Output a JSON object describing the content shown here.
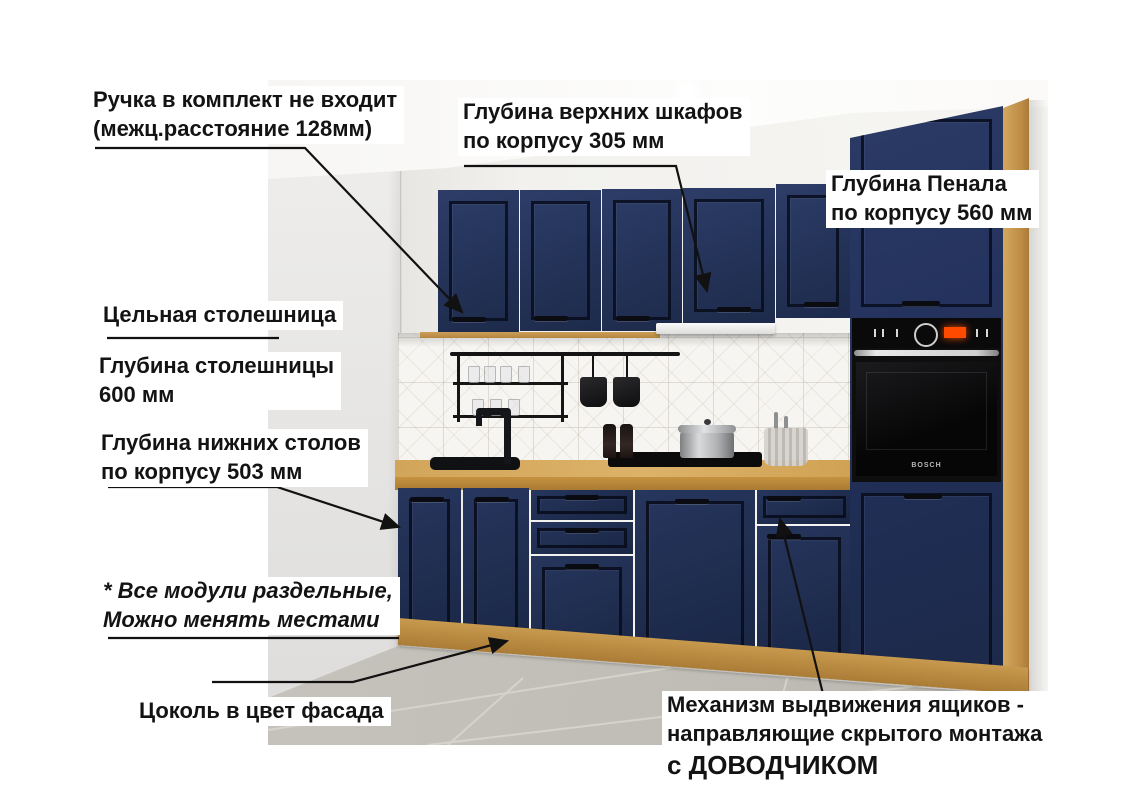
{
  "annotations": {
    "handle_note": {
      "line1": "Ручка в комплект не входит",
      "line2": "(межц.расстояние 128мм)"
    },
    "upper_cabinets_depth": {
      "line1": "Глубина верхних шкафов",
      "line2": "по корпусу 305 мм"
    },
    "tall_cabinet_depth": {
      "line1": "Глубина Пенала",
      "line2": "по корпусу 560 мм"
    },
    "solid_countertop": {
      "text": "Цельная столешница"
    },
    "countertop_depth": {
      "line1": "Глубина столешницы",
      "line2": "600 мм"
    },
    "base_cabinets_depth": {
      "line1": "Глубина нижних столов",
      "line2": "по корпусу 503 мм"
    },
    "modules_note": {
      "line1": "* Все модули раздельные,",
      "line2": "Можно менять местами"
    },
    "plinth_note": {
      "text": "Цоколь в цвет фасада"
    },
    "drawer_mechanism": {
      "line1": "Механизм выдвижения ящиков -",
      "line2": "направляющие скрытого монтажа",
      "line3": "с ДОВОДЧИКОМ"
    }
  },
  "appliances": {
    "oven_brand": "BOSCH"
  },
  "colors": {
    "facade_navy": "#24335b",
    "facade_navy_dark": "#1b2747",
    "countertop_oak": "#d2a65a",
    "plinth_oak": "#b8893f",
    "floor_gray": "#c0beb6",
    "wall_gray": "#e9e8e5",
    "annotation_text": "#131313",
    "oven_display_orange": "#ff4a00"
  }
}
